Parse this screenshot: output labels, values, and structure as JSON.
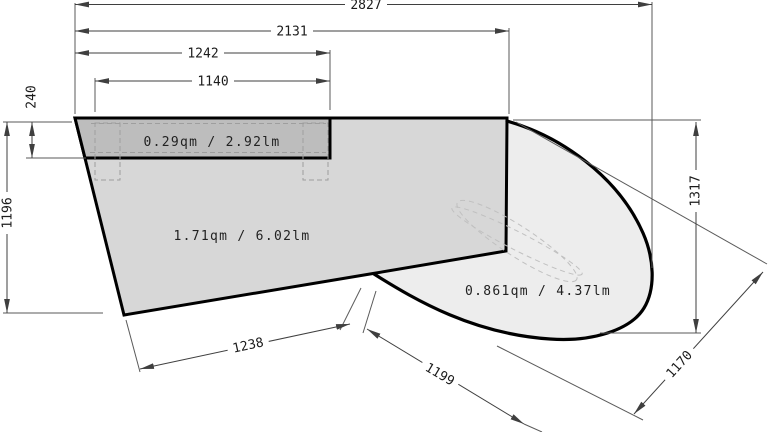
{
  "diagram": {
    "area_labels": {
      "strip": "0.29qm / 2.92lm",
      "main": "1.71qm / 6.02lm",
      "curve": "0.861qm / 4.37lm"
    },
    "dimensions": {
      "top_total": "2827",
      "top_2131": "2131",
      "top_1242": "1242",
      "top_1140": "1140",
      "left_240": "240",
      "left_1196": "1196",
      "right_1317": "1317",
      "bottom_1238": "1238",
      "bottom_1199": "1199",
      "bottom_1170": "1170"
    },
    "colors": {
      "main_fill": "#d7d7d7",
      "strip_fill": "#bdbdbd",
      "curve_fill": "#ededed",
      "outline": "#000000",
      "dim_line": "#3f3f3f",
      "ext_line": "#5a5a5a",
      "dashed": "#9e9e9e",
      "ellipse_dashed": "#c0c0c0"
    }
  }
}
